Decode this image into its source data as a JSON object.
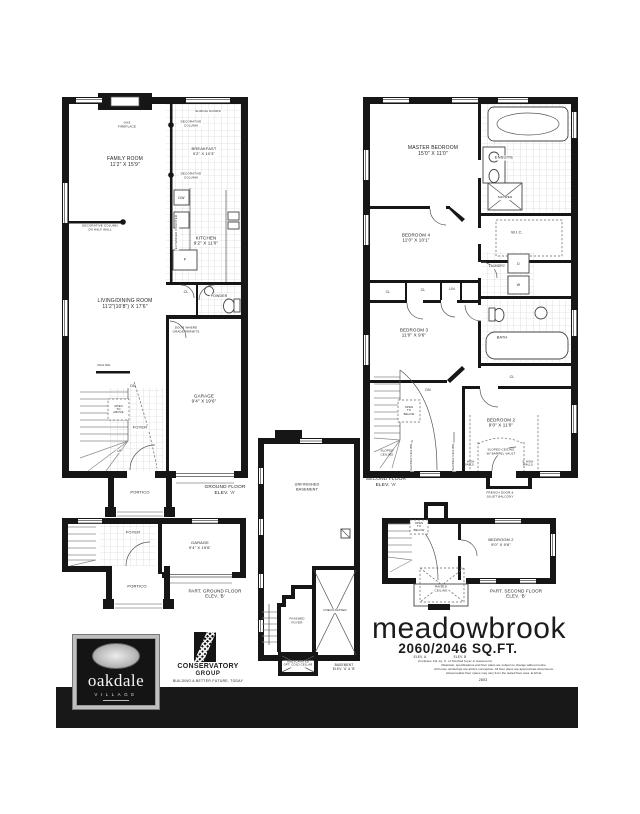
{
  "colors": {
    "wall": "#161616",
    "tile_line": "#cccccc",
    "footer_bar": "#181818"
  },
  "ground_floor": {
    "caption": "GROUND FLOOR\nELEV. 'A'",
    "labels": {
      "gas_fireplace": "GAS\nFIREPLACE",
      "sliding_doors": "SLIDING DOORS",
      "decorative_column": "DECORATIVE\nCOLUMN",
      "breakfast": "BREAKFAST\n9'2\" X 10'3\"",
      "extended_counter": "EXTENDED COUNTER",
      "dw": "DW",
      "family_room": "FAMILY ROOM\n11'2\" X 15'9\"",
      "kitchen": "KITCHEN\n9'2\" X 11'0\"",
      "fridge": "F",
      "column_half_wall": "DECORATIVE COLUMN\nON HALF WALL",
      "living_dining": "LIVING/DINING ROOM\n11'2\"(10'8\") X 17'6\"",
      "cl": "CL",
      "powder": "POWDER",
      "door_grade": "DOOR WHERE\nGRADE PERMITS",
      "garage": "GARAGE\n9'4\" X 19'6\"",
      "railing": "RAILING",
      "dn": "DN",
      "open_above": "OPEN\nTO\nABOVE",
      "foyer": "FOYER",
      "up": "UP",
      "portico": "PORTICO"
    }
  },
  "second_floor": {
    "caption": "SECOND FLOOR\nELEV. 'A'",
    "labels": {
      "master": "MASTER BEDROOM\n15'0\" X 11'0\"",
      "ensuite": "ENSUITE",
      "shower": "SHOWER",
      "wic": "W.I.C.",
      "bedroom4": "BEDROOM 4\n11'0\" X 10'1\"",
      "laundry": "LAUNDRY",
      "dryer": "D",
      "washer": "W",
      "cl": "CL",
      "lin": "LIN",
      "bedroom3": "BEDROOM 3\n11'0\" X 9'6\"",
      "bath": "BATH",
      "dn": "DN",
      "open_below": "OPEN\nTO\nBELOW",
      "sloped": "SLOPED\nCEILING",
      "sloped_v": "SLOPED CEILING",
      "bedroom2": "BEDROOM 2\n9'0\" X 11'0\"",
      "barrel": "SLOPED CEILING\nW/ BARREL VAULT",
      "high_walls": "6' HIGH\nWALLS",
      "french": "FRENCH DOOR &\nJULIET BALCONY"
    }
  },
  "basement": {
    "caption": "BASEMENT\nELEV. 'A' & 'B'",
    "labels": {
      "unfinished": "UNFINISHED\nBASEMENT",
      "finished_foyer": "FINISHED\nFOYER",
      "unexcavated": "UNEXCAVATED",
      "cold_cellar": "UNEXCAVATED\nOPT. COLD CELLAR"
    }
  },
  "part_ground": {
    "caption": "PART. GROUND FLOOR\nELEV. 'B'",
    "labels": {
      "foyer": "FOYER",
      "garage": "GARAGE\n9'4\" X 19'6\"",
      "portico": "PORTICO"
    }
  },
  "part_second": {
    "caption": "PART. SECOND FLOOR\nELEV. 'B'",
    "labels": {
      "open_below": "OPEN\nTO\nBELOW",
      "bedroom2": "BEDROOM 2\n9'0\" X 9'6\"",
      "raised": "RAISED\nCEILING"
    }
  },
  "title_block": {
    "name": "meadowbrook",
    "sqft": "2060/2046 SQ.FT.",
    "elev_a": "ELEV. A",
    "elev_b": "ELEV. B",
    "includes_note": "(Includes 111 sq. ft. of finished foyer in basement)",
    "disclaimer": "Materials, specifications and floor plans are subject to change without notice.\nAll house renderings are artist's conception. All floor plans are approximate dimensions.\nActual usable floor space may vary from the stated floor area. E.&O.E.",
    "plan_number": "2803"
  },
  "branding": {
    "oakdale": {
      "name": "oakdale",
      "subtitle": "VILLAGE"
    },
    "builder": {
      "line1": "CONSERVATORY",
      "line2": "GROUP",
      "tagline": "BUILDING A BETTER FUTURE, TODAY"
    }
  }
}
